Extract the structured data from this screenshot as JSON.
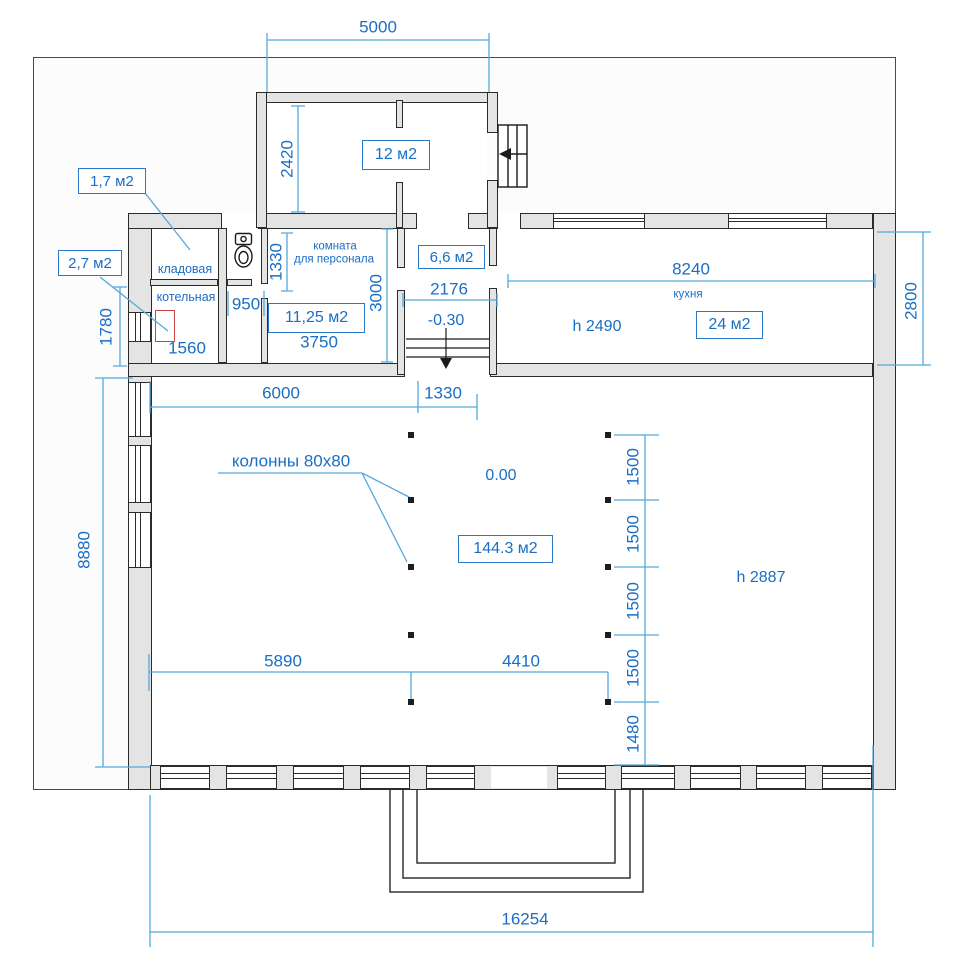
{
  "colors": {
    "dim_text": "#1a6ec5",
    "dim_line": "#55a8dc",
    "box_border": "#2979c8",
    "wall_fill": "#e4e4e4",
    "wall_edge": "#2b2b2b",
    "boiler_red": "#cc4343"
  },
  "callouts": {
    "storage": "1,7 м2",
    "boiler": "2,7 м2",
    "columns": "колонны 80x80"
  },
  "areas": {
    "tambour": "12 м2",
    "entry": "6,6 м2",
    "staff": "11,25 м2",
    "kitchen": "24 м2",
    "hall": "144.3 м2"
  },
  "rooms": {
    "storage": "кладовая",
    "boiler": "котельная",
    "staff1": "комната",
    "staff2": "для персонала",
    "kitchen": "кухня"
  },
  "levels": {
    "hall": "0.00",
    "entry": "-0.30"
  },
  "heights": {
    "kitchen": "h 2490",
    "hall": "h 2887"
  },
  "dims": {
    "tambour_w": "5000",
    "tambour_d": "2420",
    "boiler_d": "1780",
    "boiler_w": "1560",
    "wc_w": "950",
    "wc_d": "1330",
    "staff_w": "3750",
    "staff_d": "3000",
    "vest_w": "2176",
    "kitchen_w": "8240",
    "kitchen_d": "2800",
    "hall_a": "6000",
    "hall_b": "1330",
    "hall_d": "8880",
    "col_a": "5890",
    "col_b": "4410",
    "spacing": [
      "1500",
      "1500",
      "1500",
      "1500"
    ],
    "last": "1480",
    "total": "16254"
  }
}
